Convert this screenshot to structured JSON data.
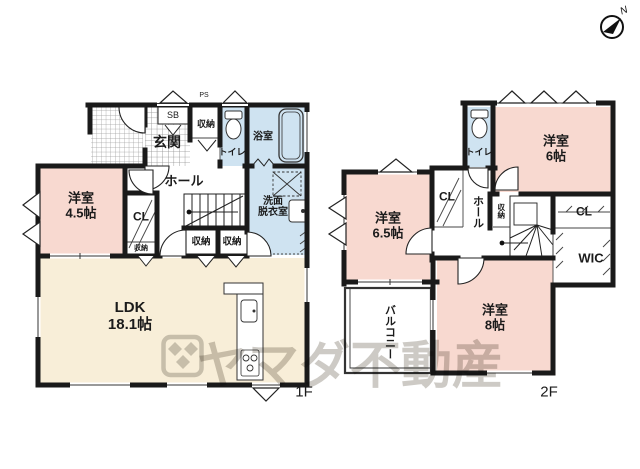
{
  "compass": {
    "north": "N"
  },
  "watermark": {
    "brand": "ヤマダ不動産"
  },
  "floor1": {
    "label": "1F",
    "entrance": "玄関",
    "shoe_box": "SB",
    "pipe_space": "PS",
    "storage_top": "収納",
    "toilet": "トイレ",
    "bathroom": "浴室",
    "hall": "ホール",
    "bedroom_45": "洋室\n4.5帖",
    "closet": "CL",
    "storage_small": "収納",
    "storage_a": "収納",
    "storage_b": "収納",
    "washroom": "洗面\n脱衣室",
    "ldk": "LDK\n18.1帖"
  },
  "floor2": {
    "label": "2F",
    "toilet": "トイレ",
    "bedroom_6": "洋室\n6帖",
    "closet_left": "CL",
    "hall": "ホール",
    "storage": "収納",
    "closet_right": "CL",
    "wic": "WIC",
    "bedroom_65": "洋室\n6.5帖",
    "balcony": "バルコニー",
    "bedroom_8": "洋室\n8帖"
  },
  "colors": {
    "room_pink": "#f8d9d0",
    "room_cream": "#f8eed8",
    "room_blue": "#cfe3f1",
    "wall": "#1a1a1a",
    "watermark": "#6b6455"
  }
}
